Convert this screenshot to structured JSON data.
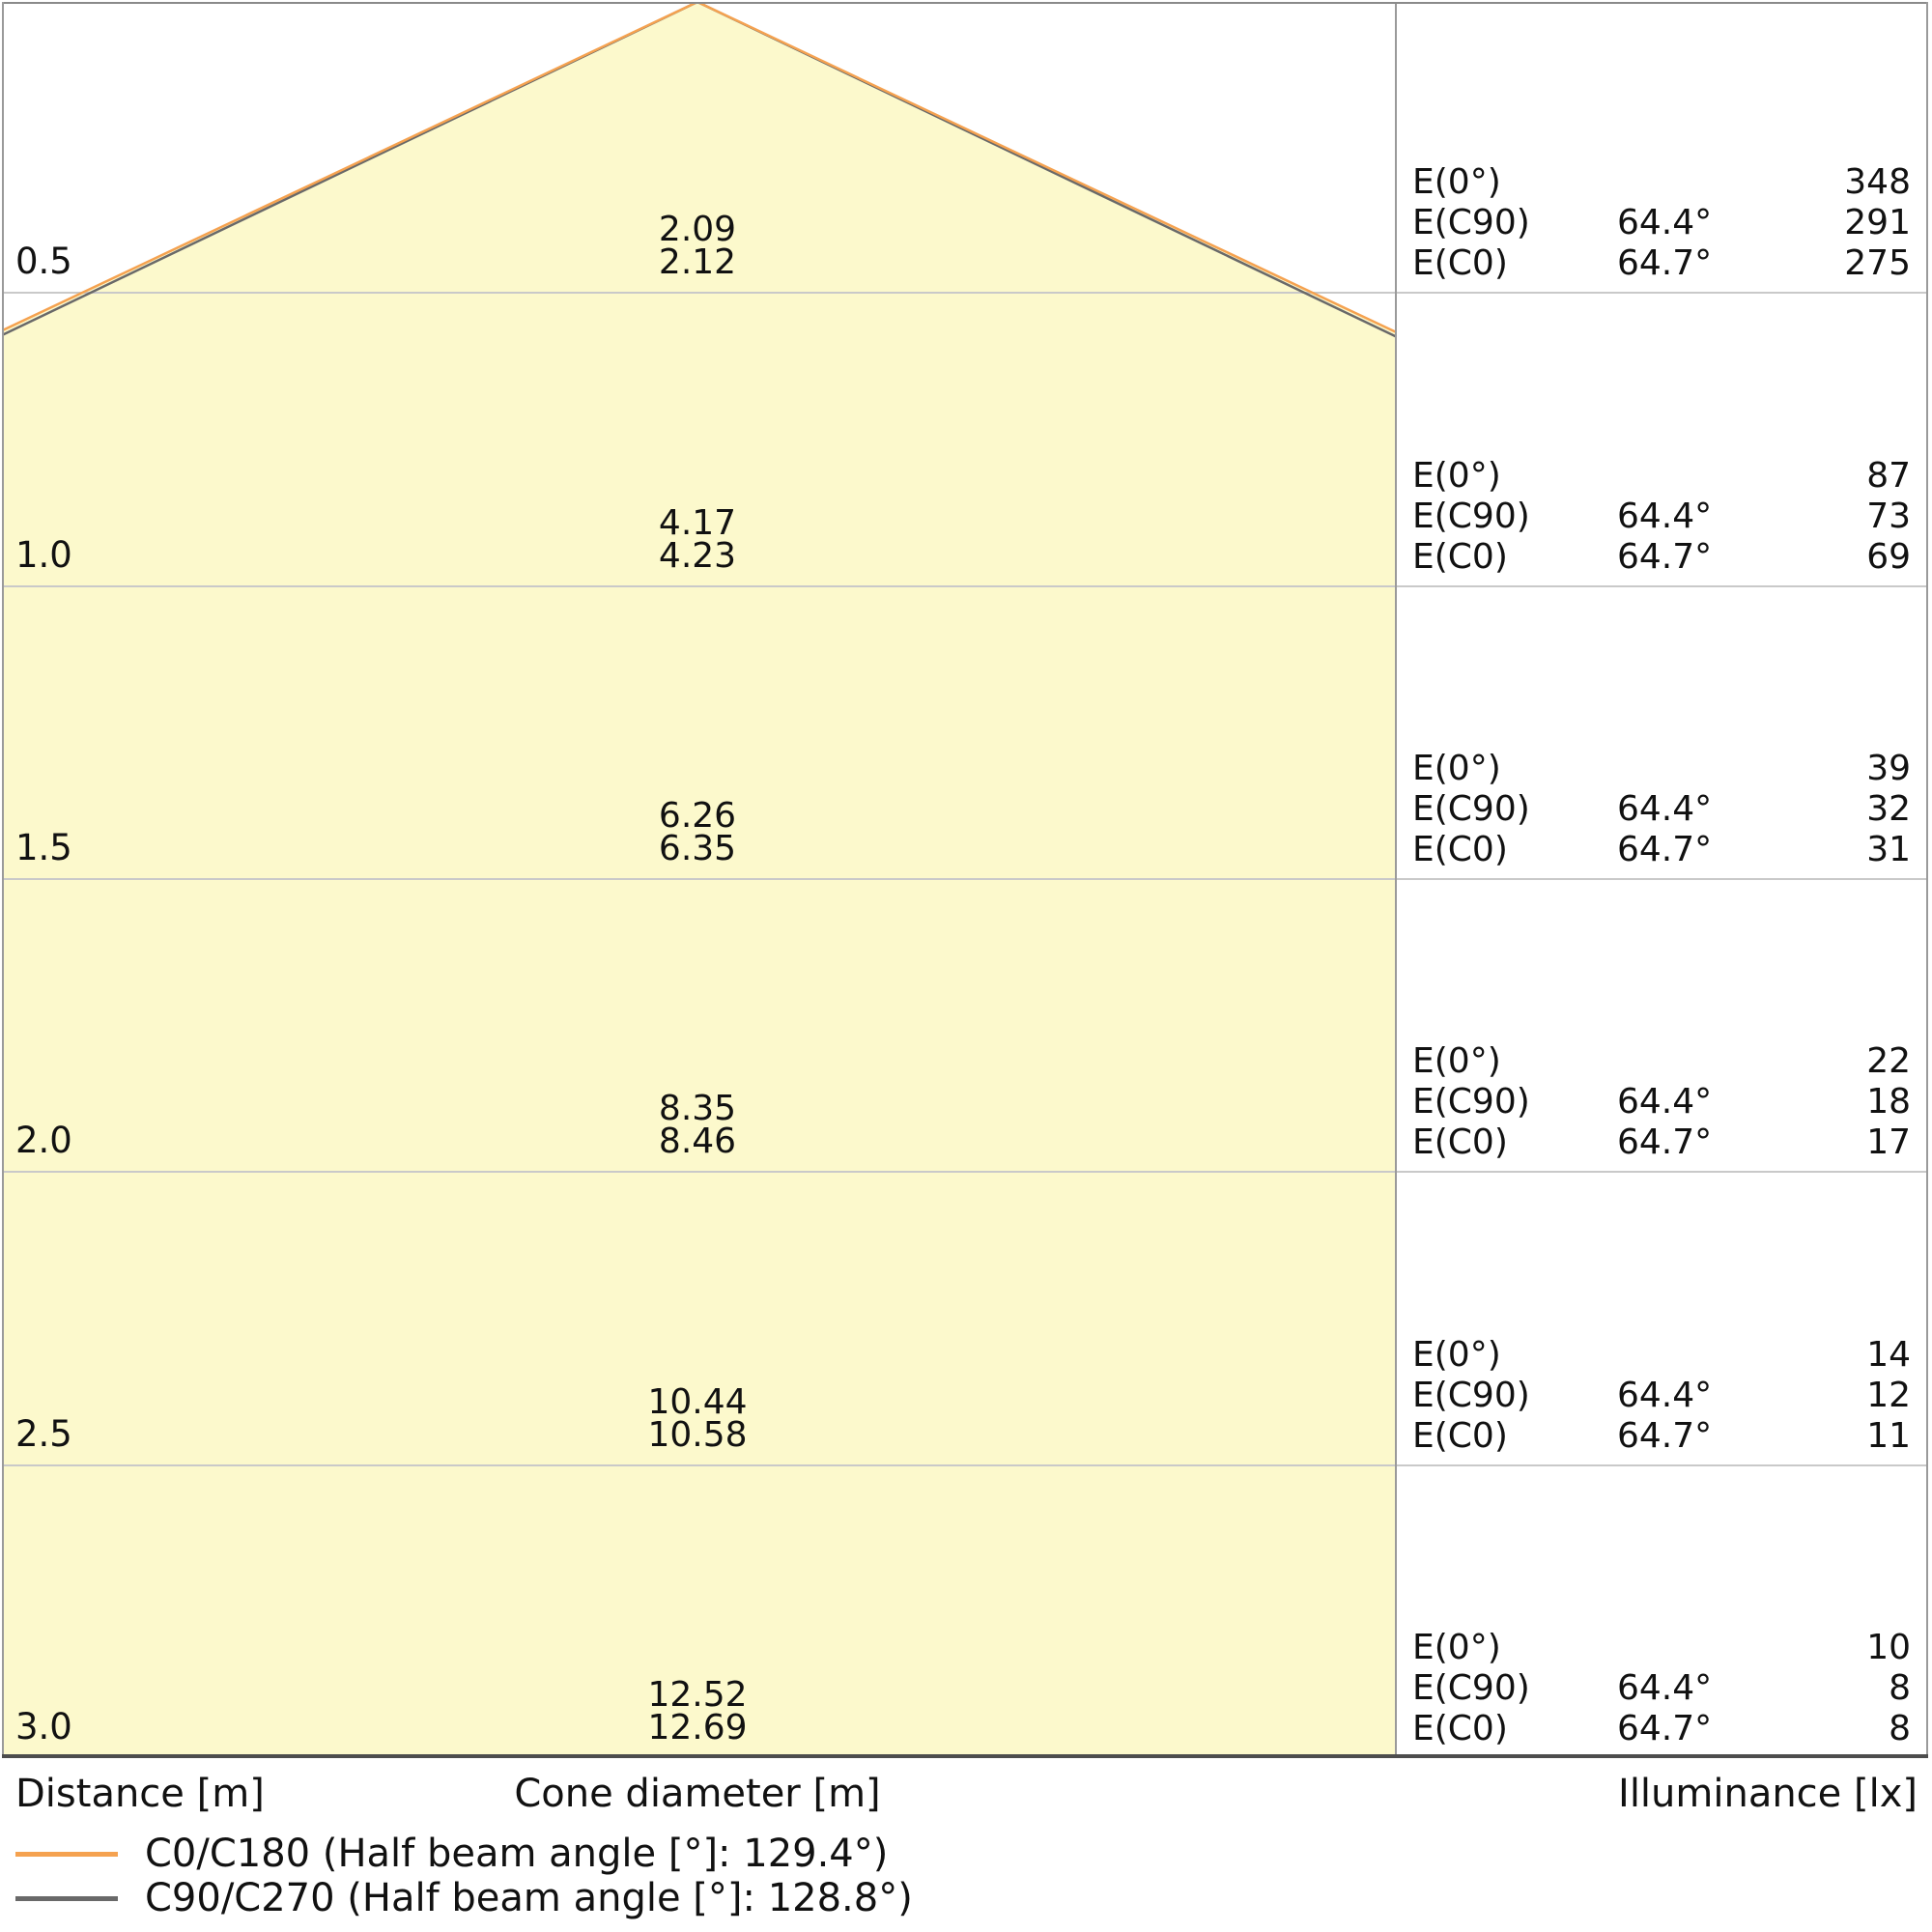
{
  "captions": {
    "distance": "Distance [m]",
    "cone_diameter": "Cone diameter [m]",
    "illuminance": "Illuminance [lx]"
  },
  "labels": {
    "e0": "E(0°)",
    "ec90": "E(C90)",
    "ec0": "E(C0)",
    "angle_c90": "64.4°",
    "angle_c0": "64.7°"
  },
  "rows": [
    {
      "distance": "0.5",
      "cone_c90": "2.09",
      "cone_c0": "2.12",
      "e0": "348",
      "ec90": "291",
      "ec0": "275"
    },
    {
      "distance": "1.0",
      "cone_c90": "4.17",
      "cone_c0": "4.23",
      "e0": "87",
      "ec90": "73",
      "ec0": "69"
    },
    {
      "distance": "1.5",
      "cone_c90": "6.26",
      "cone_c0": "6.35",
      "e0": "39",
      "ec90": "32",
      "ec0": "31"
    },
    {
      "distance": "2.0",
      "cone_c90": "8.35",
      "cone_c0": "8.46",
      "e0": "22",
      "ec90": "18",
      "ec0": "17"
    },
    {
      "distance": "2.5",
      "cone_c90": "10.44",
      "cone_c0": "10.58",
      "e0": "14",
      "ec90": "12",
      "ec0": "11"
    },
    {
      "distance": "3.0",
      "cone_c90": "12.52",
      "cone_c0": "12.69",
      "e0": "10",
      "ec90": "8",
      "ec0": "8"
    }
  ],
  "legend": [
    {
      "label": "C0/C180 (Half beam angle [°]: 129.4°)",
      "color": "#F5A250"
    },
    {
      "label": "C90/C270 (Half beam angle [°]: 128.8°)",
      "color": "#696969"
    }
  ],
  "colors": {
    "cone_fill": "#FCF9CC",
    "c0_line": "#F5A250",
    "c90_line": "#696969",
    "gridline": "#C9C9C9",
    "border": "#8A8A8A",
    "bottom_border": "#4D4D4D"
  },
  "chart_data": {
    "type": "area",
    "title": "Light cone diagram",
    "xlabel": "Cone diameter [m]",
    "ylabel": "Distance [m]",
    "value_label": "Illuminance [lx]",
    "distances_m": [
      0.5,
      1.0,
      1.5,
      2.0,
      2.5,
      3.0
    ],
    "series": [
      {
        "name": "C0/C180 (Half beam angle [°]: 129.4°)",
        "half_beam_angle_deg": 129.4,
        "angle_shown": "64.7°",
        "color": "#F5A250",
        "cone_diameter_m": [
          2.12,
          4.23,
          6.35,
          8.46,
          10.58,
          12.69
        ],
        "illuminance_lx_EC0": [
          275,
          69,
          31,
          17,
          11,
          8
        ]
      },
      {
        "name": "C90/C270 (Half beam angle [°]: 128.8°)",
        "half_beam_angle_deg": 128.8,
        "angle_shown": "64.4°",
        "color": "#696969",
        "cone_diameter_m": [
          2.09,
          4.17,
          6.26,
          8.35,
          10.44,
          12.52
        ],
        "illuminance_lx_EC90": [
          291,
          73,
          32,
          18,
          12,
          8
        ]
      }
    ],
    "illuminance_lx_E0": [
      348,
      87,
      39,
      22,
      14,
      10
    ],
    "legend_position": "bottom-left",
    "grid": true
  }
}
